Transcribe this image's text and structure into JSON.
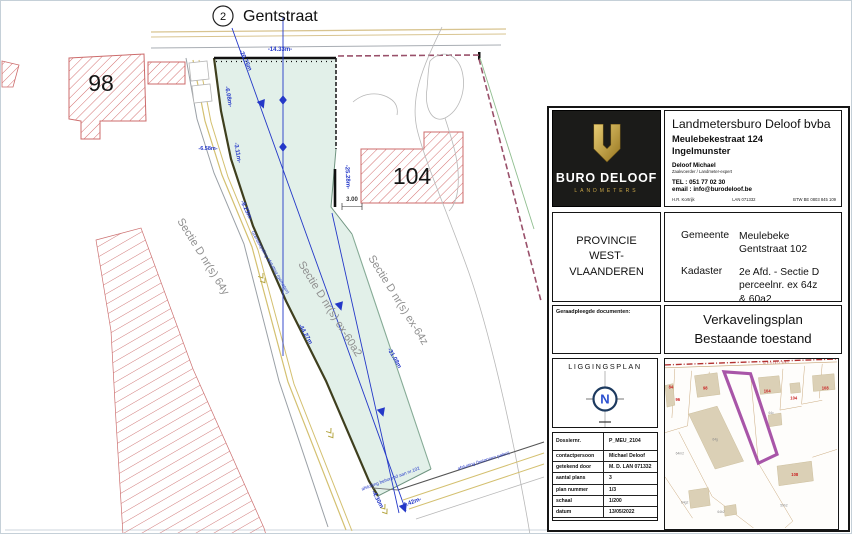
{
  "plan": {
    "node_number": "2",
    "street": "Gentstraat",
    "parcel98": "98",
    "parcel104": "104",
    "sectie_left": "Sectie D nr(s) 64y",
    "sectie_mid": "Sectie D nr(s) ex-60a2",
    "sectie_right": "Sectie D nr(s) ex-64z",
    "dims": [
      "-14.33m-",
      "-20.76m",
      "-6.08m-",
      "-6.58m-",
      "-3.11m-",
      "-9.23m-",
      "-25.28m-",
      "3.00",
      "-44.27m",
      "-31.08m",
      "-4.30m",
      "-4.42m-"
    ],
    "notes": [
      "Grensbepaling afsluiting (gemeten)",
      "afsluiting behorend aan nr.102",
      "afsluiting (betonnen palen)"
    ]
  },
  "titleblock": {
    "logo_brand": "BURO DELOOF",
    "logo_sub": "LANDMETERS",
    "company_name": "Landmetersburo Deloof bvba",
    "address1": "Meulebekestraat 124",
    "address2": "Ingelmunster",
    "person": "Deloof Michael",
    "person_role": "Zaakvoerder / Landmeter-expert",
    "tel": "TEL : 051 77 02 30",
    "email": "email : info@burodeloof.be",
    "reg1": "H.R. Kortrijk",
    "reg2": "LAN 071332",
    "reg3": "BTW BE 0803 845 109",
    "province1": "PROVINCIE",
    "province2": "WEST-VLAANDEREN",
    "gemeente_label": "Gemeente",
    "gemeente1": "Meulebeke",
    "gemeente2": "Gentstraat 102",
    "kadaster_label": "Kadaster",
    "kadaster1": "2e Afd. - Sectie D",
    "kadaster2": "perceelnr. ex 64z",
    "kadaster3": "& 60a2",
    "docs_label": "Geraadpleegde documenten:",
    "doc_title1": "Verkavelingsplan",
    "doc_title2": "Bestaande toestand",
    "liggingsplan": "LIGGINGSPLAN",
    "north": "N",
    "table": [
      {
        "label": "Dossiernr.",
        "value": "P_MEU_2104"
      },
      {
        "label": "contactpersoon",
        "value": "Michael Deloof"
      },
      {
        "label": "getekend door",
        "value": "M. D. LAN 071332"
      },
      {
        "label": "aantal plans",
        "value": "3"
      },
      {
        "label": "plan nummer",
        "value": "1/3"
      },
      {
        "label": "schaal",
        "value": "1/200"
      },
      {
        "label": "datum",
        "value": "13/05/2022"
      }
    ]
  },
  "map": {
    "street": "Gentstraat",
    "red_labels": [
      "84",
      "96",
      "98",
      "104",
      "104",
      "108",
      "108"
    ],
    "gray_labels": [
      "64c",
      "64g",
      "64b2",
      "64g2",
      "59h2",
      "64m2"
    ]
  },
  "colors": {
    "parcel_fill": "#e2f0e9",
    "highlight_purple": "#a855a8",
    "dimension_blue": "#2438c8",
    "hatch_red": "#cc6b6b",
    "road_tan": "#d4c070"
  }
}
